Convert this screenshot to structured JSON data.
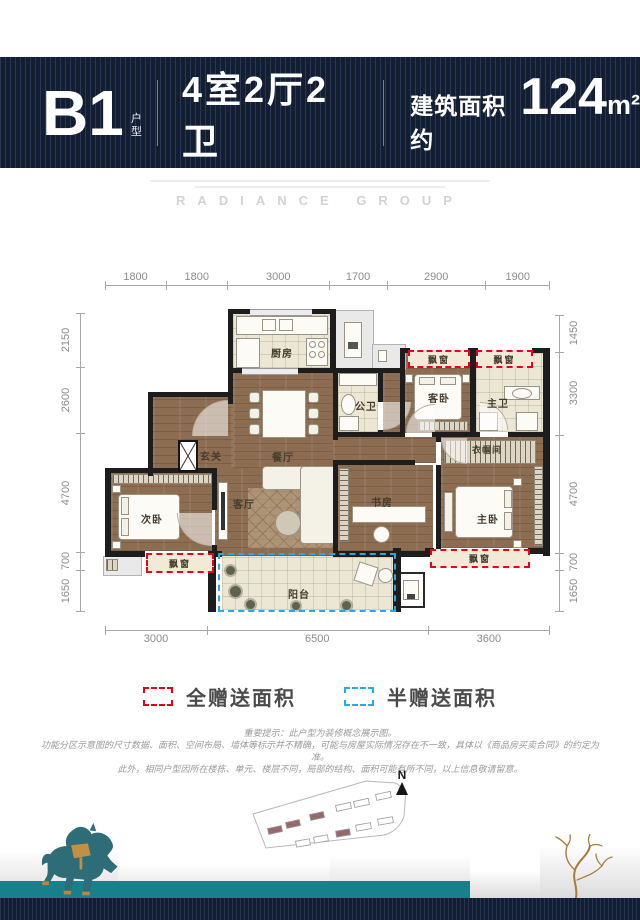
{
  "header": {
    "unit": "B1",
    "unit_suffix": "户型",
    "layout": "4室2厅2卫",
    "area_prefix": "建筑面积约",
    "area_value": "124",
    "area_unit": "m²"
  },
  "brand": {
    "name": "RADIANCE GROUP"
  },
  "dimensions": {
    "top": [
      1800,
      1800,
      3000,
      1700,
      2900,
      1900
    ],
    "bottom": [
      3000,
      6500,
      3600
    ],
    "left": [
      2150,
      2600,
      4700,
      700,
      1650
    ],
    "right": [
      1450,
      3300,
      4700,
      700,
      1650
    ]
  },
  "rooms": {
    "kitchen": "厨房",
    "dining": "餐厅",
    "entry": "玄关",
    "living": "客厅",
    "second_bedroom": "次卧",
    "study": "书房",
    "master_bedroom": "主卧",
    "guest_bedroom": "客卧",
    "public_bath": "公卫",
    "master_bath": "主卫",
    "cloakroom": "衣帽间",
    "balcony": "阳台",
    "bay_window": "飘窗"
  },
  "legend": {
    "items": [
      {
        "label": "全赠送面积",
        "color": "#e60012"
      },
      {
        "label": "半赠送面积",
        "color": "#29abe2"
      }
    ]
  },
  "disclaimer": {
    "line1": "重要提示：此户型为装修概念展示图。",
    "line2": "功能分区示意图的尺寸数据、面积、空间布局、墙体等标示并不精确，可能与房屋实际情况存在不一致，具体以《商品房买卖合同》的约定为准。",
    "line3": "此外，相同户型因所在楼栋、单元、楼层不同，局部的结构、面积可能有所不同，以上信息敬请留意。"
  },
  "compass": {
    "label": "N"
  }
}
